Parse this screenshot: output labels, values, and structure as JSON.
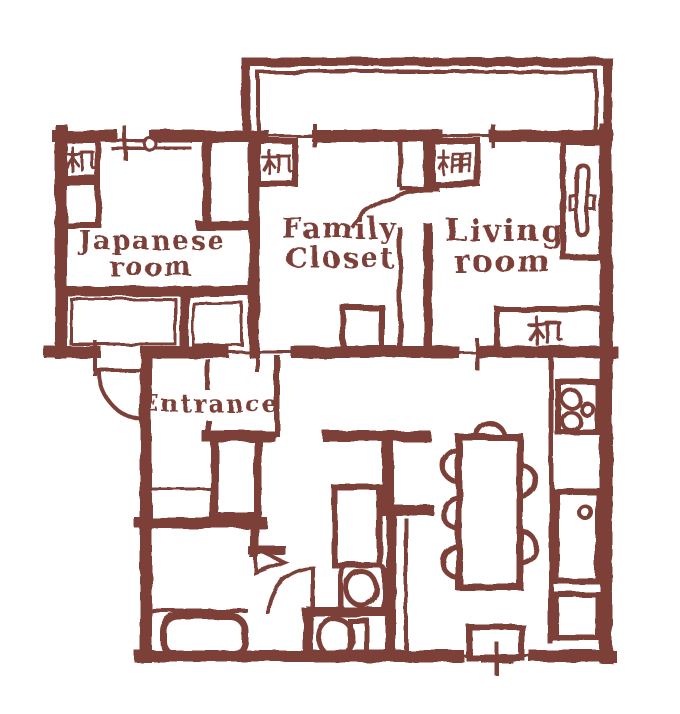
{
  "plan": {
    "background_color": "#ffffff",
    "ink_color": "#7c4138",
    "rooms": {
      "japanese_room": {
        "line1": "Japanese",
        "line2": "room"
      },
      "family_closet": {
        "line1": "Family",
        "line2": "Closet"
      },
      "living_room": {
        "line1": "Living",
        "line2": "room"
      },
      "entrance": {
        "label": "Entrance"
      }
    },
    "fixtures": {
      "desk_kanji": "机",
      "shelf_kanji": "棚"
    }
  }
}
